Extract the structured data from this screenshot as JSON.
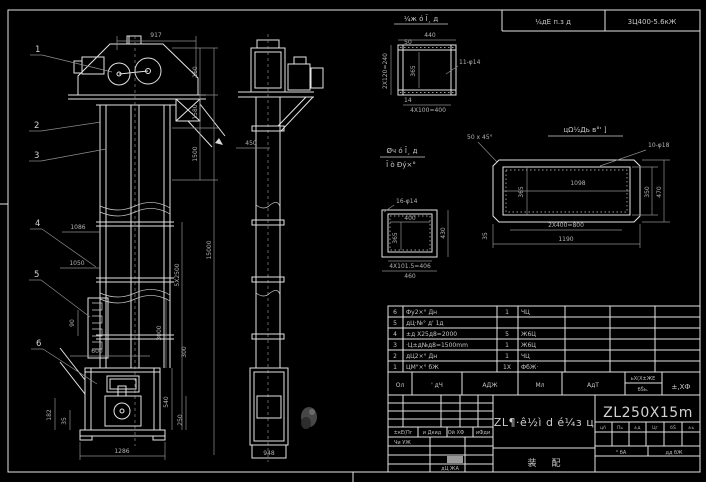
{
  "frame": {
    "header_left": "¼дЕ п.з д",
    "header_right": "3Ц400-5.6кЖ"
  },
  "balloons": {
    "b1": "1",
    "b2": "2",
    "b3": "3",
    "b4": "4",
    "b5": "5",
    "b6": "6"
  },
  "notes": {
    "top_part": "¼ж ó Ī¸ д",
    "mid_line1": "Øч ó Ī¸ д",
    "mid_line2": "Ī ò Đý×°",
    "chamfer": "50 x 45°",
    "plate_title": "цΩ½Дь в°' ]"
  },
  "dims": {
    "d917": "917",
    "d160": "160",
    "d1580": "1580",
    "d1500": "1500",
    "d15000": "15000",
    "d5x2500": "5X2500",
    "d3000": "3000",
    "d300": "300",
    "d540": "540",
    "d250": "250",
    "d1086": "1086",
    "d1050": "1050",
    "d90": "90",
    "d600": "600",
    "d1286": "1286",
    "d182": "182",
    "d35b": "35",
    "d450": "450",
    "d948": "948",
    "d440": "440",
    "d50": "50",
    "d11f14": "11-φ14",
    "d2x120": "2X120=240",
    "d365a": "365",
    "d14": "14",
    "d4x100": "4X100=400",
    "d16f14": "16-φ14",
    "d400": "400",
    "d365b": "365",
    "d430": "430",
    "d4x1015": "4X101.5=406",
    "d460": "460",
    "d10f18": "10-φ18",
    "d1098": "1098",
    "d365c": "365",
    "d350": "350",
    "d470": "470",
    "d2x400": "2X400=800",
    "d1190": "1190",
    "d35a": "35"
  },
  "parts_table": {
    "rows": [
      {
        "no": "6",
        "name": "Фу2×° Дн",
        "qty": "1",
        "mat": "ЧЦ"
      },
      {
        "no": "5",
        "name": "дЦ·№° д' 1д",
        "qty": "",
        "mat": ""
      },
      {
        "no": "4",
        "name": "±д X25д8=2000",
        "qty": "5",
        "mat": "Ж6Ц"
      },
      {
        "no": "3",
        "name": "·Ц±д№д8=1500mm",
        "qty": "1",
        "mat": "Ж6Ц"
      },
      {
        "no": "2",
        "name": "дЦ2×° Дн",
        "qty": "1",
        "mat": "ЧЦ"
      },
      {
        "no": "1",
        "name": "ЦМ\"×° бЖ",
        "qty": "1X",
        "mat": "ФбЖ·"
      }
    ],
    "footer": {
      "c1": "Ол",
      "c2": "' дЧ",
      "c3": "АДЖ",
      "c4": "Мл",
      "c5": "АдТ",
      "c6a": "ьΧ(X±ЖE",
      "c6b": "бŠь.",
      "c7": "±,XФ"
    }
  },
  "title_block": {
    "model": "ZL250X15m",
    "drawing_title": "ZL¶·ê½ì d é¼з ц",
    "stage1": "装",
    "stage2": "配",
    "left": {
      "h1": "±кЕ(Пг",
      "h2": "и Дкид",
      "h3": "Ой ХФ",
      "h4": "иФди",
      "r1": "Чи УЖ",
      "r2": "дЦ ЖА"
    },
    "right": {
      "s1": "цñ",
      "s2": "Пь",
      "s3": "±д",
      "s4": "Цг",
      "s5": "бŠ",
      "s6": "±ь",
      "a1": "° бА",
      "a2": "дд бЖ"
    }
  }
}
